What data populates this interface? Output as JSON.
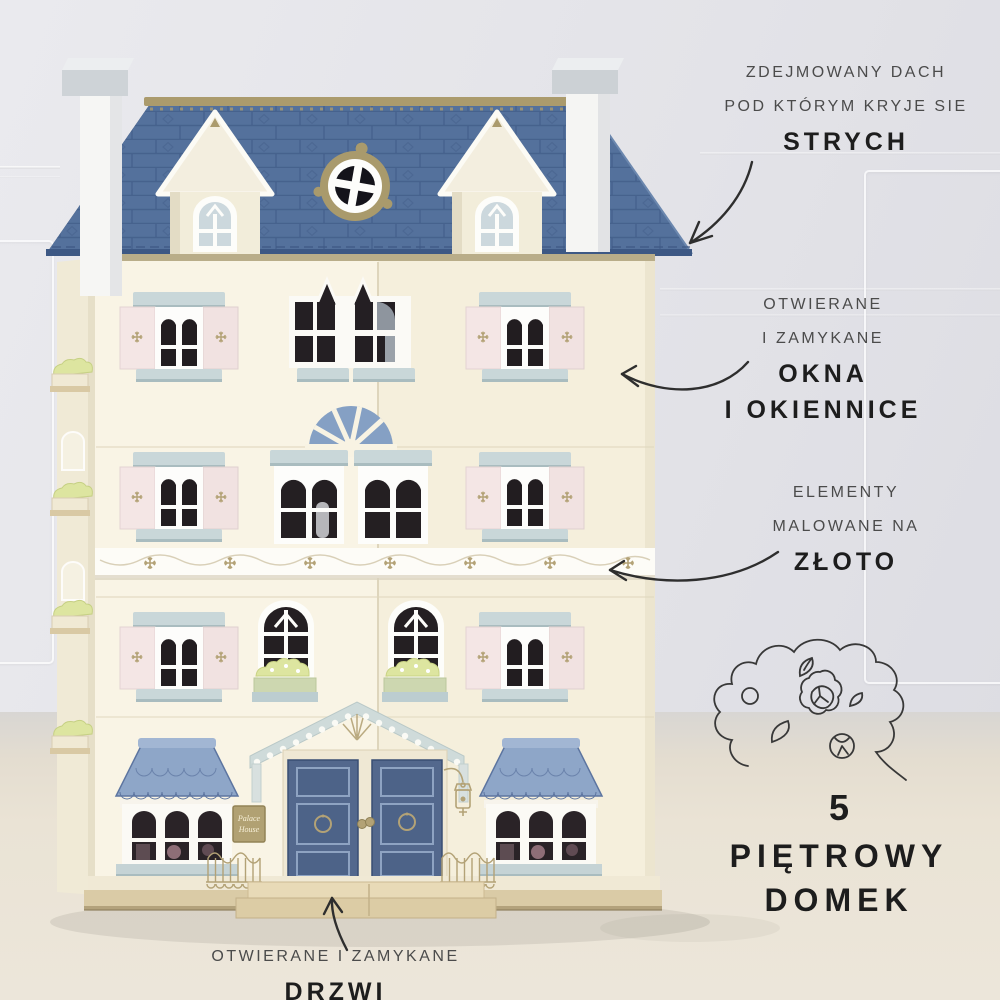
{
  "annotations": {
    "attic_note": {
      "line1": "ZDEJMOWANY DACH",
      "line2": "POD KTÓRYM KRYJE SIE",
      "emphasis": "STRYCH"
    },
    "windows_note": {
      "line1": "OTWIERANE",
      "line2": "I ZAMYKANE",
      "emphasis1": "OKNA",
      "emphasis2": "I OKIENNICE"
    },
    "gold_note": {
      "line1": "ELEMENTY",
      "line2": "MALOWANE NA",
      "emphasis": "ZŁOTO"
    },
    "storeys_note": {
      "number": "5",
      "line1": "PIĘTROWY",
      "line2": "DOMEK"
    },
    "door_note": {
      "line1": "OTWIERANE I ZAMYKANE",
      "emphasis": "DRZWI"
    }
  },
  "house": {
    "sign": {
      "line1": "Palace",
      "line2": "House"
    }
  },
  "icons": {
    "arrow": "hand-drawn-curved-arrow",
    "flower": "flower-doodle",
    "lantern": "gold-lantern",
    "fence": "gold-fence",
    "snowflake": "gold-snowflake-motif"
  },
  "colors": {
    "roof_blue": "#54719c",
    "bay_roof_blue": "#8ea6c8",
    "door_blue": "#53688d",
    "facade_cream": "#f8f3e3",
    "shutter_pink": "#f3e5e4",
    "trim_blue_gray": "#c9d7d9",
    "gold": "#ab9b6d",
    "wood": "#dacba6",
    "leaf_green": "#dde5a0",
    "wall_gray": "#e4e4e9",
    "floor_beige": "#eae3d6",
    "text_dark": "#1d1d1d",
    "text_gray": "#4b4b4b"
  }
}
